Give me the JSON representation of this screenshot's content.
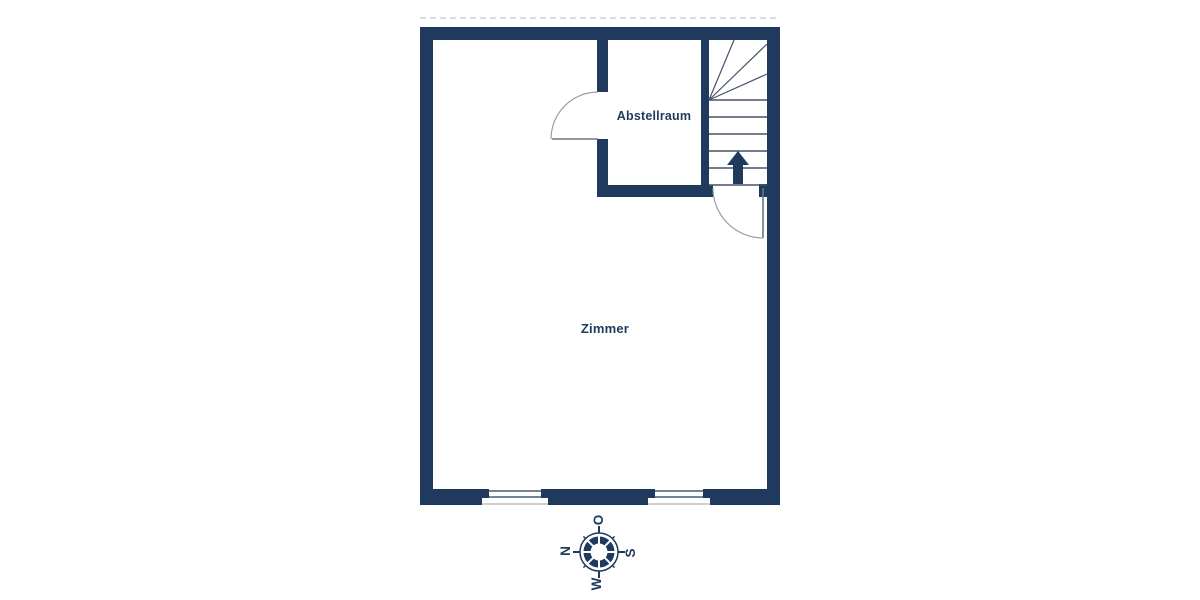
{
  "title": "Floor plan",
  "rooms": {
    "storage_room": {
      "label": "Abstellraum"
    },
    "main_room": {
      "label": "Zimmer"
    }
  },
  "stairs": {
    "icon": "up-arrow",
    "description": "staircase with winder treads, direction up"
  },
  "compass": {
    "icon": "compass-rose",
    "north": "N",
    "east": "O",
    "south": "S",
    "west": "W"
  },
  "colors": {
    "wall": "#1f3a5c",
    "stair_line": "#44536a",
    "door_leaf": "#6a7480",
    "door_arc": "#98a0aa",
    "label_text": "#1f3a5c",
    "dashed": "#ccd0d5"
  }
}
